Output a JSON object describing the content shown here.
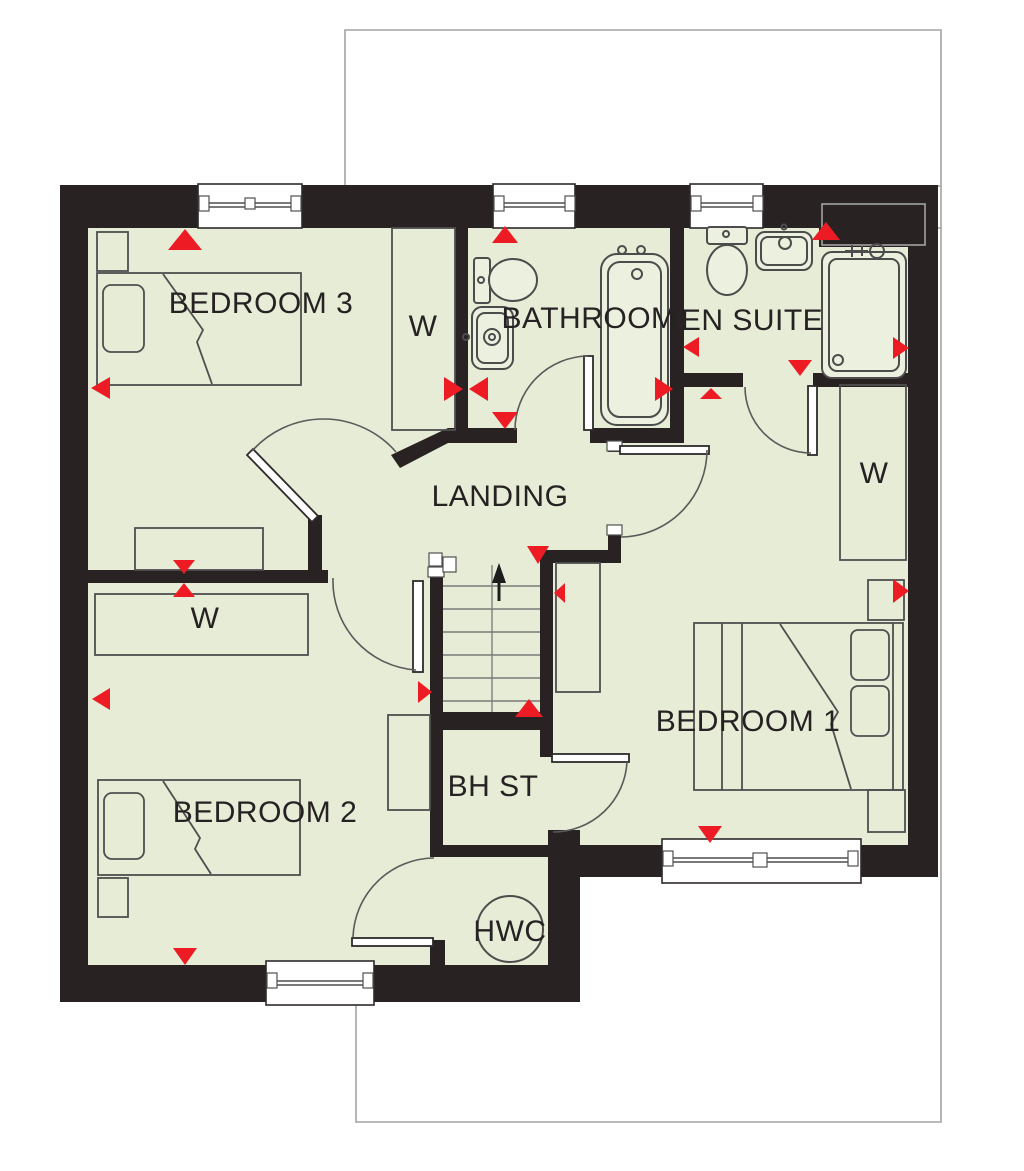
{
  "plan": {
    "type": "floor-plan",
    "rooms": {
      "bedroom3": {
        "label": "BEDROOM 3"
      },
      "wardrobe_bedroom3": {
        "label": "W"
      },
      "bathroom": {
        "label": "BATHROOM"
      },
      "ensuite": {
        "label": "EN SUITE"
      },
      "landing": {
        "label": "LANDING"
      },
      "wardrobe_bedroom2": {
        "label": "W"
      },
      "bedroom2": {
        "label": "BEDROOM 2"
      },
      "bhst": {
        "label": "BH ST"
      },
      "hwc": {
        "label": "HWC"
      },
      "bedroom1": {
        "label": "BEDROOM 1"
      },
      "wardrobe_bedroom1": {
        "label": "W"
      }
    }
  },
  "colors": {
    "floor": "#e6ecd5",
    "wall": "#282223",
    "red": "#ed1c24",
    "fixture": "#ebf1de",
    "line": "#4c4c4c",
    "outline": "#a3a3a3",
    "text": "#262122"
  }
}
